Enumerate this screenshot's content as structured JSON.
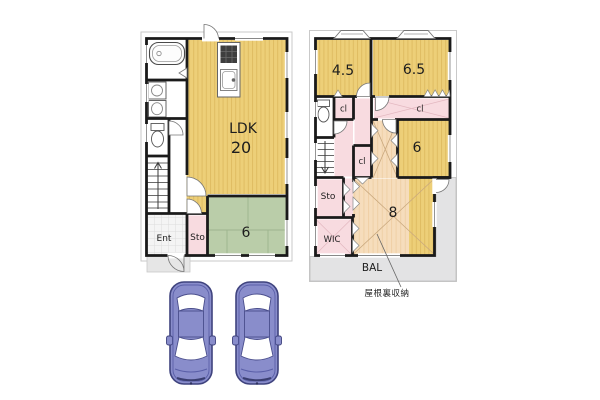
{
  "floor1": {
    "ldk_label": "LDK",
    "ldk_size": "20",
    "tatami_size": "6",
    "entrance_label": "Ent",
    "storage_label": "Sto"
  },
  "floor2": {
    "room_a_size": "4.5",
    "room_b_size": "6.5",
    "room_c_size": "6",
    "room_d_size": "8",
    "closet_a_label": "cl",
    "closet_b_label": "cl",
    "closet_c_label": "cl",
    "storage_label": "Sto",
    "wic_label": "WIC",
    "balcony_label": "BAL"
  },
  "annotation": {
    "attic_label": "屋根裏収納"
  },
  "colors": {
    "wood_floor": "#EDCF78",
    "wood_stripe": "#DFBC62",
    "tatami": "#BACDA9",
    "tatami_line": "#9DB48E",
    "pink": "#F8DBE0",
    "peach": "#F6DDBC",
    "balcony_gray": "#E3E3E4",
    "wall": "#1A1A1A",
    "car_body": "#898DCB",
    "car_outline": "#3F437E"
  }
}
